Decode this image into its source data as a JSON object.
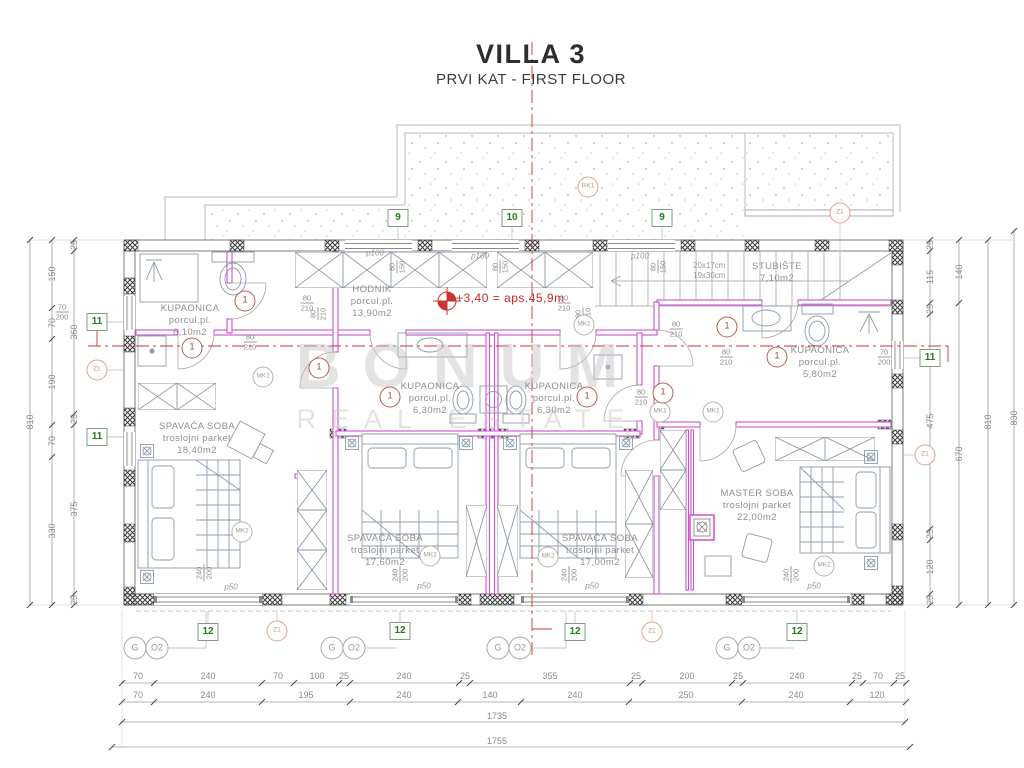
{
  "title": {
    "main": "VILLA 3",
    "subtitle": "PRVI KAT - FIRST FLOOR"
  },
  "watermark": {
    "line1": "BONUM",
    "line2": "REAL ESTATE"
  },
  "elevation": {
    "label": "+3,40  =  aps.45,9m"
  },
  "rooms": [
    {
      "name": "KUPAONICA",
      "sub": "porcul.pl.",
      "area": "6,10m2"
    },
    {
      "name": "HODNIK",
      "sub": "porcul.pl.",
      "area": "13,90m2"
    },
    {
      "name": "SPAVAĆA SOBA",
      "sub": "troslojni parket",
      "area": "18,40m2"
    },
    {
      "name": "KUPAONICA",
      "sub": "porcul.pl.",
      "area": "6,30m2"
    },
    {
      "name": "KUPAONICA",
      "sub": "porcul.pl.",
      "area": "6,30m2"
    },
    {
      "name": "SPAVAĆA SOBA",
      "sub": "troslojni parket",
      "area": "17,60m2"
    },
    {
      "name": "SPAVAĆA SOBA",
      "sub": "troslojni parket",
      "area": "17,00m2"
    },
    {
      "name": "MASTER SOBA",
      "sub": "troslojni parket",
      "area": "22,00m2"
    },
    {
      "name": "KUPAONICA",
      "sub": "porcul.pl.",
      "area": "5,80m2"
    },
    {
      "name": "STUBIŠTE",
      "area": "7,10m2"
    }
  ],
  "stairs": {
    "note1": "20x17cm",
    "note2": "19x30cm"
  },
  "markers": {
    "sq9": "9",
    "sq10": "10",
    "sq11": "11",
    "sq12": "12",
    "z1": "Z1",
    "rk1": "RK1",
    "mk1": "MK1",
    "mk2": "MK2",
    "door": "1",
    "g": "G",
    "o2": "O2"
  },
  "labels": {
    "n80": "80",
    "n210": "210",
    "n70": "70",
    "n200": "200",
    "n150": "150",
    "n240": "240",
    "p100": "p100",
    "p50": "p50"
  },
  "dims": {
    "left_outer": "810",
    "left_mid": [
      "150",
      "70",
      "190",
      "70",
      "330"
    ],
    "left_inner": [
      "25",
      "360",
      "25",
      "375",
      "25"
    ],
    "right_inner": [
      "25",
      "115",
      "25",
      "475",
      "25",
      "120",
      "25"
    ],
    "right_mid": [
      "140",
      "670"
    ],
    "right_outer": "810",
    "right_outer2": "830",
    "bottom_row1": [
      "70",
      "240",
      "70",
      "100",
      "25",
      "240",
      "25",
      "355",
      "25",
      "200",
      "25",
      "240",
      "25",
      "70",
      "25"
    ],
    "bottom_row2": [
      "70",
      "240",
      "195",
      "240",
      "140",
      "240",
      "250",
      "240",
      "120"
    ],
    "total_inner": "1735",
    "total_outer": "1755"
  },
  "colors": {
    "partition_magenta": "#cf4fcf",
    "axis_red": "#cc3333",
    "marker_green": "#1e7d1e",
    "wall_gray": "#7d7d7d"
  }
}
